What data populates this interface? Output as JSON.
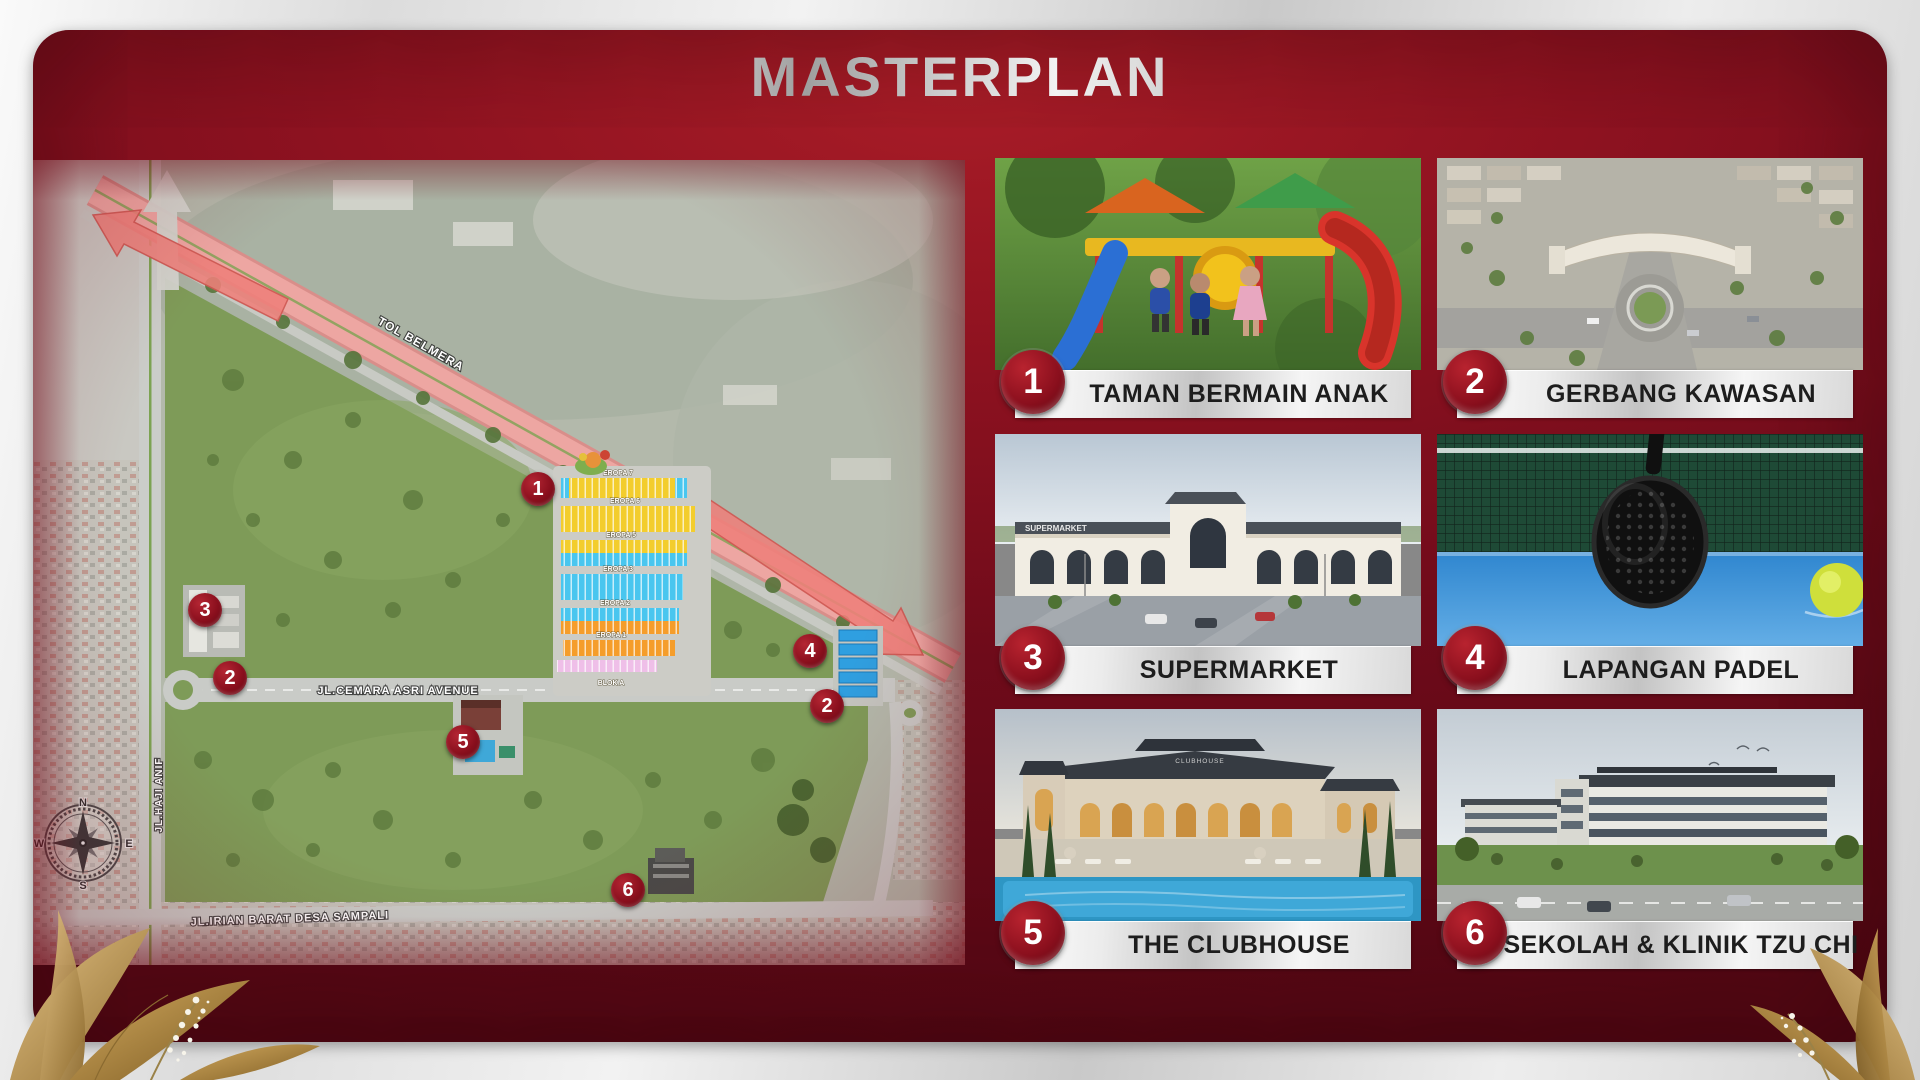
{
  "title": "MASTERPLAN",
  "map": {
    "roads": {
      "highway": "TOL BELMERA",
      "avenue": "JL.CEMARA ASRI AVENUE",
      "west": "JL.HAJI ANIF",
      "south": "JL.IRIAN BARAT DESA SAMPALI"
    },
    "blocks": [
      "EROPA 7",
      "EROPA 6",
      "EROPA 5",
      "EROPA 3",
      "EROPA 2",
      "EROPA 1"
    ],
    "block_area": "BLOK A",
    "compass": {
      "n": "N",
      "e": "E",
      "s": "S",
      "w": "W"
    },
    "markers": [
      {
        "number": "1"
      },
      {
        "number": "2"
      },
      {
        "number": "3"
      },
      {
        "number": "4"
      },
      {
        "number": "2"
      },
      {
        "number": "5"
      },
      {
        "number": "6"
      }
    ]
  },
  "legend": {
    "items": [
      {
        "number": "1",
        "label": "TAMAN BERMAIN ANAK"
      },
      {
        "number": "2",
        "label": "GERBANG KAWASAN"
      },
      {
        "number": "3",
        "label": "SUPERMARKET"
      },
      {
        "number": "4",
        "label": "LAPANGAN PADEL"
      },
      {
        "number": "5",
        "label": "THE CLUBHOUSE"
      },
      {
        "number": "6",
        "label": "SEKOLAH & KLINIK TZU CHI"
      }
    ]
  },
  "signs": {
    "supermarket": "SUPERMARKET",
    "clubhouse": "CLUBHOUSE"
  },
  "colors": {
    "panel_red": "#7c0e1d",
    "panel_red_bright": "#a31b26",
    "badge_red": "#8a0f1d",
    "silver": "#d9d9d9",
    "label_text": "#1d1d1d",
    "highway_pink": "#eda6a2",
    "site_green": "#7e9b58"
  }
}
